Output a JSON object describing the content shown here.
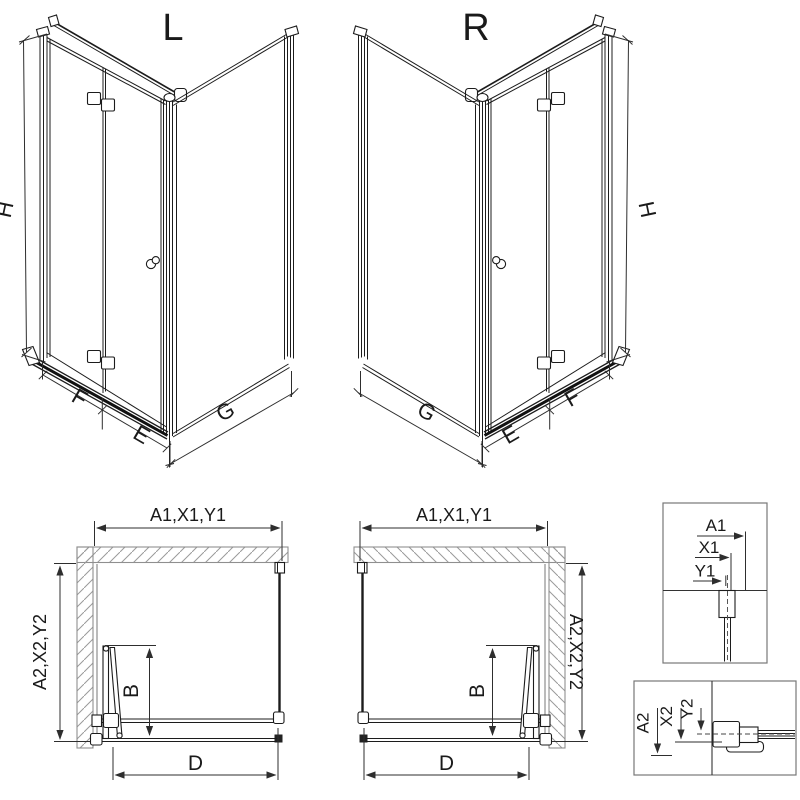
{
  "titles": {
    "left": "L",
    "right": "R"
  },
  "iso_dims": {
    "height": "H",
    "panel_f": "F",
    "panel_e": "E",
    "panel_g": "G"
  },
  "plan_dims": {
    "top": "A1,X1,Y1",
    "side": "A2,X2,Y2",
    "fold": "B",
    "opening": "D"
  },
  "details": {
    "a1": "A1",
    "x1": "X1",
    "y1": "Y1",
    "a2": "A2",
    "x2": "X2",
    "y2": "Y2"
  },
  "colors": {
    "line": "#1c1c1c",
    "dim_line": "#2e2e2e",
    "wall_outline": "#8f8f8f",
    "hatch": "#9a9a9a",
    "background": "#ffffff",
    "dark_fill": "#222222"
  }
}
